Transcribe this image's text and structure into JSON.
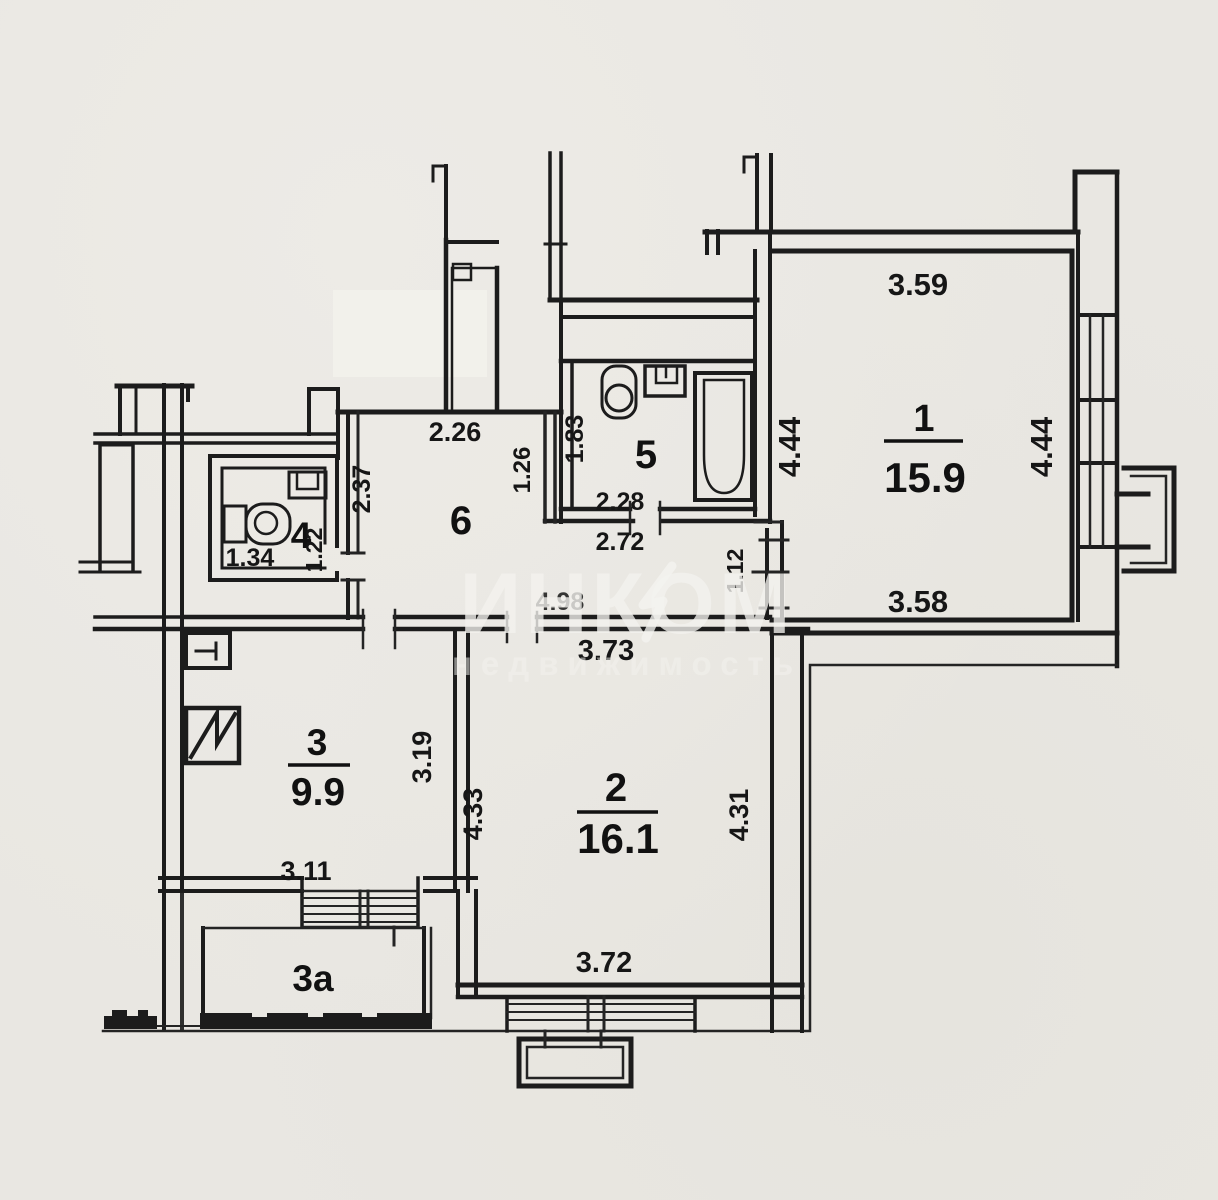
{
  "labels": {
    "r1_number": "1",
    "r1_area": "15.9",
    "dim_r1_top": "3.59",
    "dim_r1_left": "4.44",
    "dim_r1_right": "4.44",
    "dim_r1_bottom": "3.58",
    "r5_number": "5",
    "dim_r5_depth": "1.83",
    "dim_r5_width_inner": "2.28",
    "dim_r5_width_outer": "2.72",
    "dim_r5_niche": "1.26",
    "r6_number": "6",
    "dim_r6_top": "2.26",
    "dim_r6_left": "2.37",
    "r4_number": "4",
    "dim_r4_width": "1.34",
    "dim_r4_door": "1.22",
    "dim_hall_length": "4.98",
    "dim_r1_entry": "1.12",
    "r2_number": "2",
    "r2_area": "16.1",
    "dim_r2_top": "3.73",
    "dim_r2_left": "4.33",
    "dim_r2_right": "4.31",
    "dim_r2_bottom": "3.72",
    "r3_number": "3",
    "r3_area": "9.9",
    "dim_r3_right": "3.19",
    "dim_r3_bottom": "3.11",
    "r3a_number": "3a"
  },
  "watermark": {
    "brand": "ИНКОМ",
    "subtitle": "недвижимость"
  },
  "colors": {
    "paper": "#e9e7e2",
    "ink": "#1c1c1c",
    "watermark": "#f4f3ef"
  }
}
